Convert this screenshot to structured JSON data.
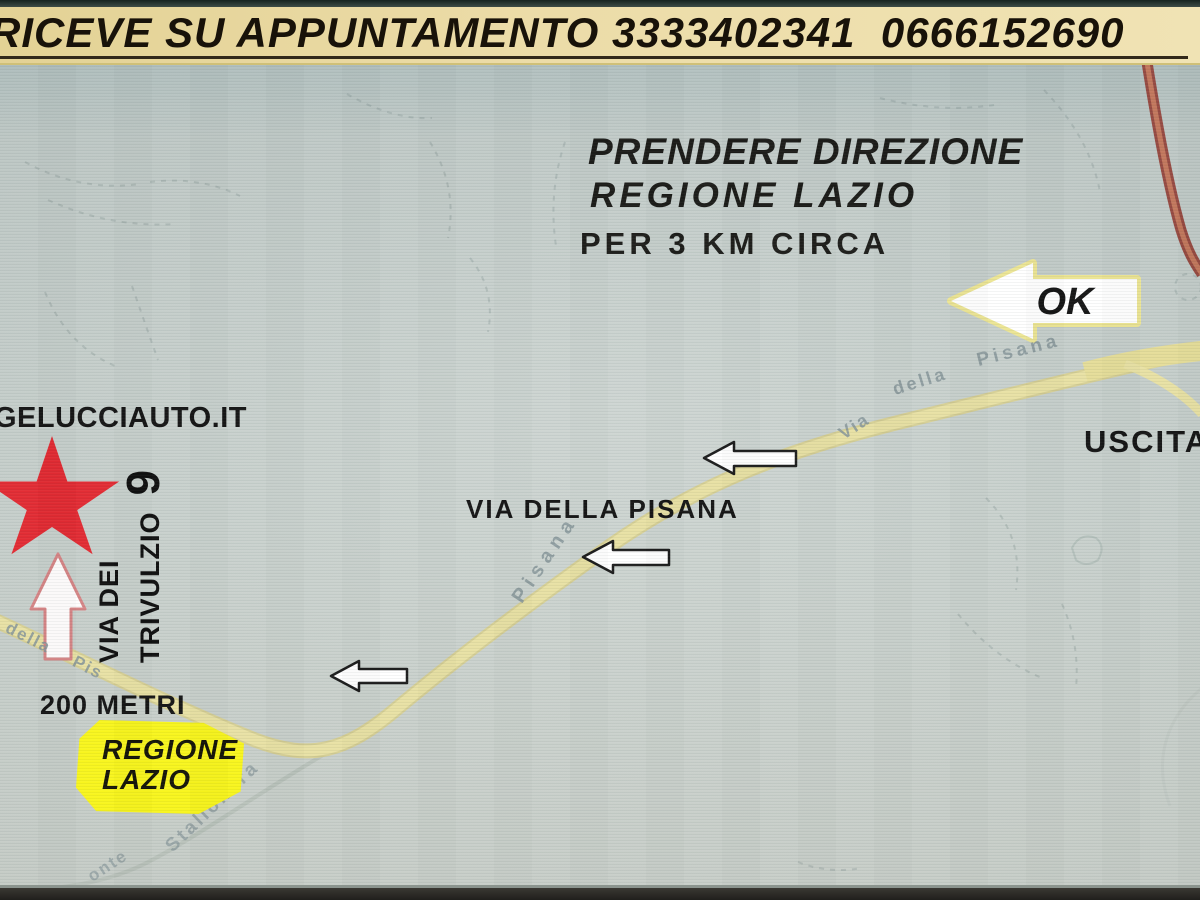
{
  "banner": {
    "text": "RICEVE SU APPUNTAMENTO 3333402341  0666152690"
  },
  "directions": {
    "line1": "PRENDERE DIREZIONE",
    "line2": "REGIONE LAZIO",
    "line3": "PER 3 KM CIRCA"
  },
  "ok_marker": {
    "label": "OK"
  },
  "uscita_label": "USCITA",
  "dealer": {
    "website": "GELUCCIAUTO.IT",
    "address_line1": "VIA DEI",
    "address_line2": "TRIVULZIO",
    "address_number": "9",
    "distance": "200 METRI"
  },
  "main_road_label": "VIA DELLA PISANA",
  "region_badge": {
    "line1": "REGIONE",
    "line2": "LAZIO"
  },
  "street_names": {
    "pisana_upper_via": "Via",
    "pisana_upper_della": "della",
    "pisana_upper_name": "Pisana",
    "pisana_mid_name": "Pisana",
    "pisana_lower_della": "della",
    "pisana_lower_name": "Pis",
    "stallonara": "Stallonara",
    "monte_fragment": "onte"
  },
  "colors": {
    "banner_bg": "#ecdca8",
    "map_bg": "#ccd4d0",
    "road_yellow": "#e8e1a4",
    "highway_red": "#93423a",
    "star_red": "#e22b33",
    "badge_yellow": "#f8f51c",
    "arrow_white": "#ffffff"
  }
}
